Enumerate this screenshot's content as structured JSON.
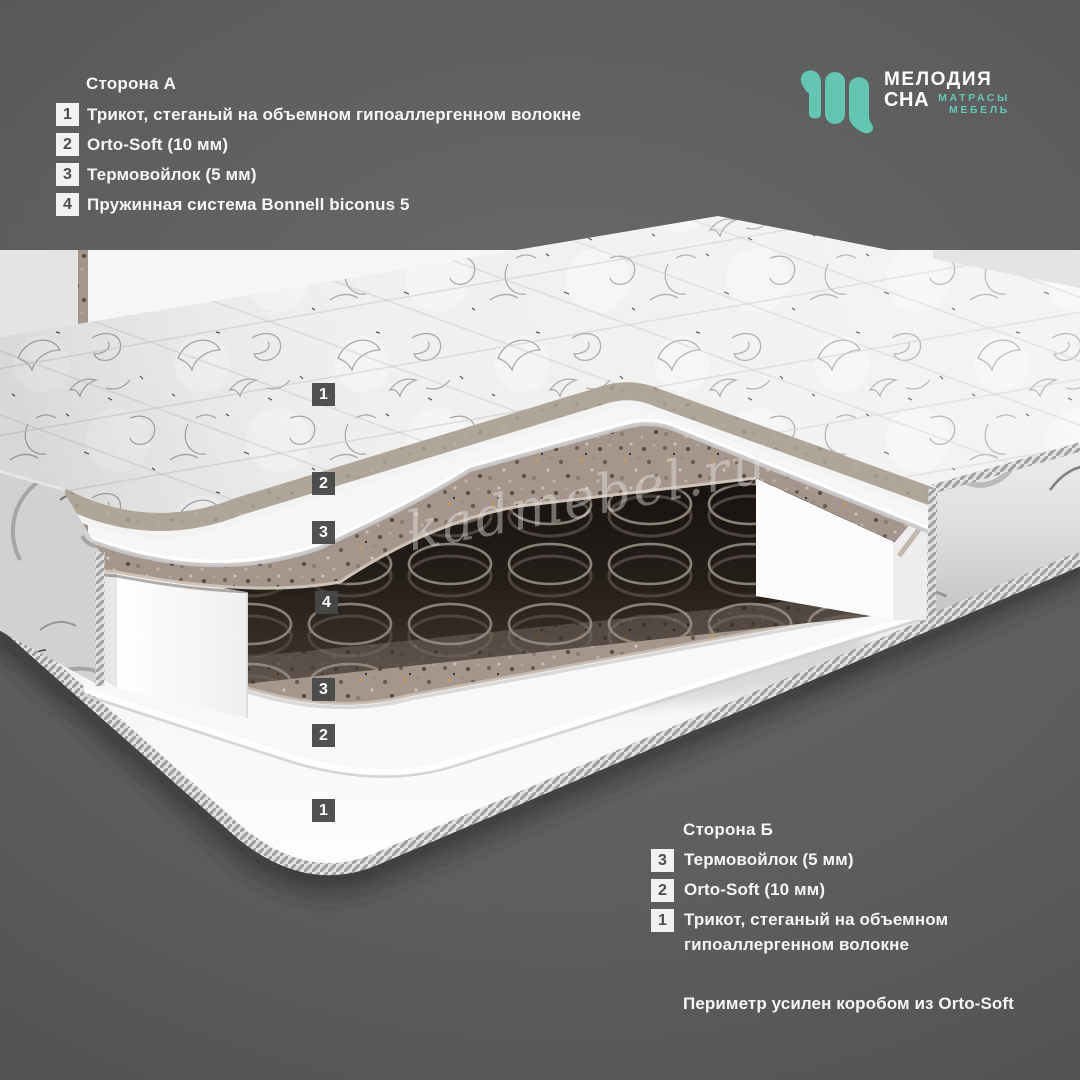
{
  "logo": {
    "icon": "melodiya-sna-monogram",
    "brand_top": "МЕЛОДИЯ",
    "brand_bottom": "СНА",
    "tagline_top": "МАТРАСЫ",
    "tagline_bottom": "МЕБЕЛЬ",
    "accent_color": "#63c6b2"
  },
  "side_a": {
    "title": "Сторона А",
    "items": [
      {
        "num": "1",
        "label": "Трикот, стеганый на объемном гипоаллергенном волокне"
      },
      {
        "num": "2",
        "label": "Orto-Soft (10 мм)"
      },
      {
        "num": "3",
        "label": "Термовойлок (5 мм)"
      },
      {
        "num": "4",
        "label": "Пружинная система Bonnell biconus 5"
      }
    ]
  },
  "side_b": {
    "title": "Сторона Б",
    "items": [
      {
        "num": "3",
        "label": "Термовойлок (5 мм)"
      },
      {
        "num": "2",
        "label": "Orto-Soft (10 мм)"
      },
      {
        "num": "1",
        "label": "Трикот, стеганый на объемном гипоаллергенном волокне"
      }
    ]
  },
  "footer_note": "Периметр усилен коробом из Orto-Soft",
  "watermark": "kadmebel.ru",
  "diagram": {
    "description": "mattress-cutaway-layers",
    "tags": [
      {
        "num": "1",
        "x": 312,
        "y": 383
      },
      {
        "num": "2",
        "x": 312,
        "y": 472
      },
      {
        "num": "3",
        "x": 312,
        "y": 521
      },
      {
        "num": "4",
        "x": 315,
        "y": 591
      },
      {
        "num": "3",
        "x": 312,
        "y": 678
      },
      {
        "num": "2",
        "x": 312,
        "y": 724
      },
      {
        "num": "1",
        "x": 312,
        "y": 799
      }
    ]
  }
}
